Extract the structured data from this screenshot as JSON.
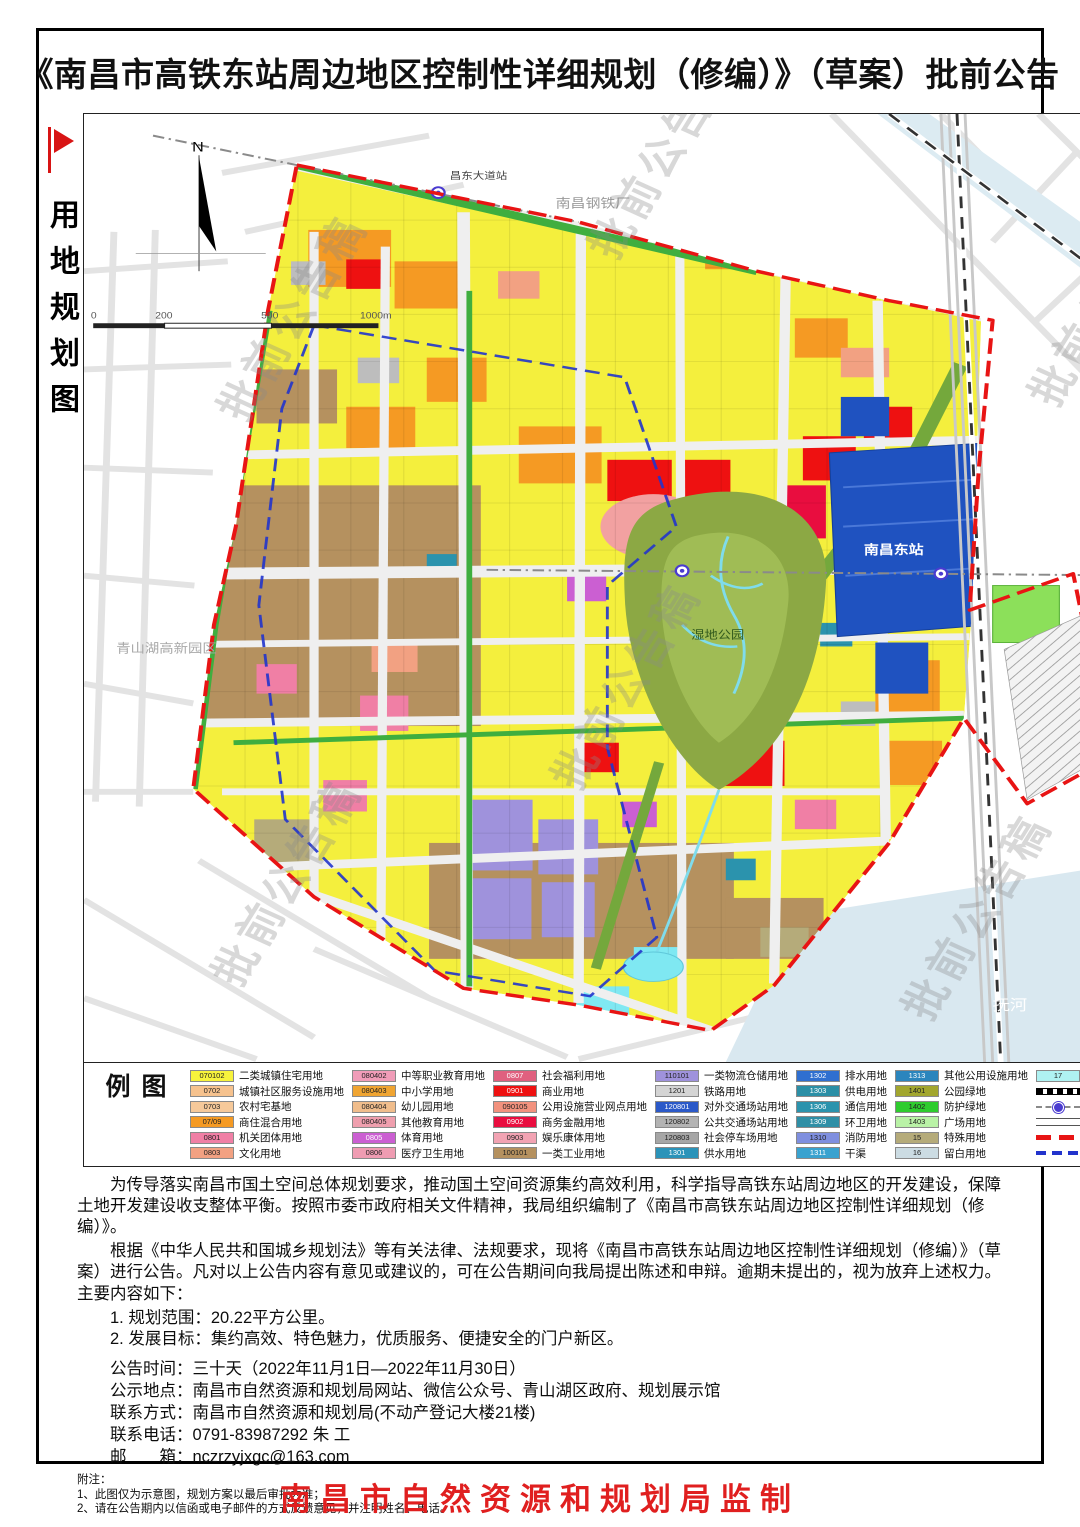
{
  "title": "《南昌市高铁东站周边地区控制性详细规划（修编）》（草案）批前公告",
  "sidebar": {
    "label": "用地规划图"
  },
  "map": {
    "compass": "N",
    "scale": [
      "0",
      "200",
      "500",
      "1000m"
    ],
    "watermark": "批前公告稿",
    "labels": {
      "station": "南昌东站",
      "metro_station": "昌东大道站",
      "steel_plant": "南昌钢铁厂",
      "hi_tech_zone": "青山湖高新园区",
      "river": "抚河",
      "wetland": "湿地公园"
    }
  },
  "legend": {
    "heading": "图例",
    "columns": [
      {
        "items": [
          {
            "code": "070102",
            "label": "二类城镇住宅用地",
            "color": "#f7f33c"
          },
          {
            "code": "0702",
            "label": "城镇社区服务设施用地",
            "color": "#f6c28e"
          },
          {
            "code": "0703",
            "label": "农村宅基地",
            "color": "#f6c99a"
          },
          {
            "code": "07/09",
            "label": "商住混合用地",
            "color": "#f59a23"
          },
          {
            "code": "0801",
            "label": "机关团体用地",
            "color": "#f07fa5"
          },
          {
            "code": "0803",
            "label": "文化用地",
            "color": "#f2a182"
          }
        ]
      },
      {
        "items": [
          {
            "code": "080402",
            "label": "中等职业教育用地",
            "color": "#f09cb8"
          },
          {
            "code": "080403",
            "label": "中小学用地",
            "color": "#f0a532"
          },
          {
            "code": "080404",
            "label": "幼儿园用地",
            "color": "#f0bd8c"
          },
          {
            "code": "080405",
            "label": "其他教育用地",
            "color": "#ef9fae"
          },
          {
            "code": "0805",
            "label": "体育用地",
            "color": "#cb5fd2"
          },
          {
            "code": "0806",
            "label": "医疗卫生用地",
            "color": "#ef9cb2"
          }
        ]
      },
      {
        "items": [
          {
            "code": "0807",
            "label": "社会福利用地",
            "color": "#e0607f"
          },
          {
            "code": "0901",
            "label": "商业用地",
            "color": "#ee1111"
          },
          {
            "code": "090105",
            "label": "公用设施营业网点用地",
            "color": "#f2927e"
          },
          {
            "code": "0902",
            "label": "商务金融用地",
            "color": "#e90d3f"
          },
          {
            "code": "0903",
            "label": "娱乐康体用地",
            "color": "#f2a3b3"
          },
          {
            "code": "100101",
            "label": "一类工业用地",
            "color": "#b5915f"
          }
        ]
      },
      {
        "items": [
          {
            "code": "110101",
            "label": "一类物流仓储用地",
            "color": "#9f92dc"
          },
          {
            "code": "1201",
            "label": "铁路用地",
            "color": "#d4d4d4"
          },
          {
            "code": "120801",
            "label": "对外交通场站用地",
            "color": "#2b59c8"
          },
          {
            "code": "120802",
            "label": "公共交通场站用地",
            "color": "#b3b3b3"
          },
          {
            "code": "120803",
            "label": "社会停车场用地",
            "color": "#a6a6a6"
          },
          {
            "code": "1301",
            "label": "供水用地",
            "color": "#2b93b9"
          }
        ]
      },
      {
        "items": [
          {
            "code": "1302",
            "label": "排水用地",
            "color": "#2f6fd0"
          },
          {
            "code": "1303",
            "label": "供电用地",
            "color": "#2b8fa6"
          },
          {
            "code": "1306",
            "label": "通信用地",
            "color": "#2b93ad"
          },
          {
            "code": "1309",
            "label": "环卫用地",
            "color": "#2f8fa6"
          },
          {
            "code": "1310",
            "label": "消防用地",
            "color": "#7f8fdf"
          },
          {
            "code": "1311",
            "label": "干渠",
            "color": "#39a2cf"
          }
        ]
      },
      {
        "items": [
          {
            "code": "1313",
            "label": "其他公用设施用地",
            "color": "#2b85bd"
          },
          {
            "code": "1401",
            "label": "公园绿地",
            "color": "#a2a62e"
          },
          {
            "code": "1402",
            "label": "防护绿地",
            "color": "#2ecc2e"
          },
          {
            "code": "1403",
            "label": "广场用地",
            "color": "#b9f2a6"
          },
          {
            "code": "15",
            "label": "特殊用地",
            "color": "#b5ab7a"
          },
          {
            "code": "16",
            "label": "留白用地",
            "color": "#ccdce3"
          }
        ]
      },
      {
        "items": [
          {
            "code": "17",
            "label": "陆地水域",
            "color": "#aff2f2"
          }
        ],
        "symbols": [
          {
            "type": "railway",
            "label": "铁路"
          },
          {
            "type": "metro",
            "label": "地铁线及站点"
          },
          {
            "type": "road",
            "label": "城市道路"
          },
          {
            "type": "plan",
            "label": "规划范围"
          },
          {
            "type": "core",
            "label": "核心区范围"
          }
        ]
      }
    ]
  },
  "notice": {
    "para1": "为传导落实南昌市国土空间总体规划要求，推动国土空间资源集约高效利用，科学指导高铁东站周边地区的开发建设，保障土地开发建设收支整体平衡。按照市委市政府相关文件精神，我局组织编制了《南昌市高铁东站周边地区控制性详细规划（修编）》。",
    "para2": "根据《中华人民共和国城乡规划法》等有关法律、法规要求，现将《南昌市高铁东站周边地区控制性详细规划（修编）》（草案）进行公告。凡对以上公告内容有意见或建议的，可在公告期间向我局提出陈述和申辩。逾期未提出的，视为放弃上述权力。主要内容如下：",
    "items": [
      "1. 规划范围：20.22平方公里。",
      "2. 发展目标：集约高效、特色魅力，优质服务、便捷安全的门户新区。"
    ],
    "schedule": [
      {
        "label": "公告时间：",
        "value": "三十天（2022年11月1日—2022年11月30日）"
      },
      {
        "label": "公示地点：",
        "value": "南昌市自然资源和规划局网站、微信公众号、青山湖区政府、规划展示馆"
      },
      {
        "label": "联系方式：",
        "value": "南昌市自然资源和规划局(不动产登记大楼21楼)"
      },
      {
        "label": "联系电话：",
        "value": "0791-83987292 朱 工"
      },
      {
        "label": "邮　　箱：",
        "value": "nczrzyjxgc@163.com"
      }
    ],
    "notes_title": "附注：",
    "notes": [
      "1、此图仅为示意图，规划方案以最后审批为准；",
      "2、请在公告期内以信函或电子邮件的方式反馈意见，并注明姓名、电话。"
    ]
  },
  "footer": "南昌市自然资源和规划局监制"
}
